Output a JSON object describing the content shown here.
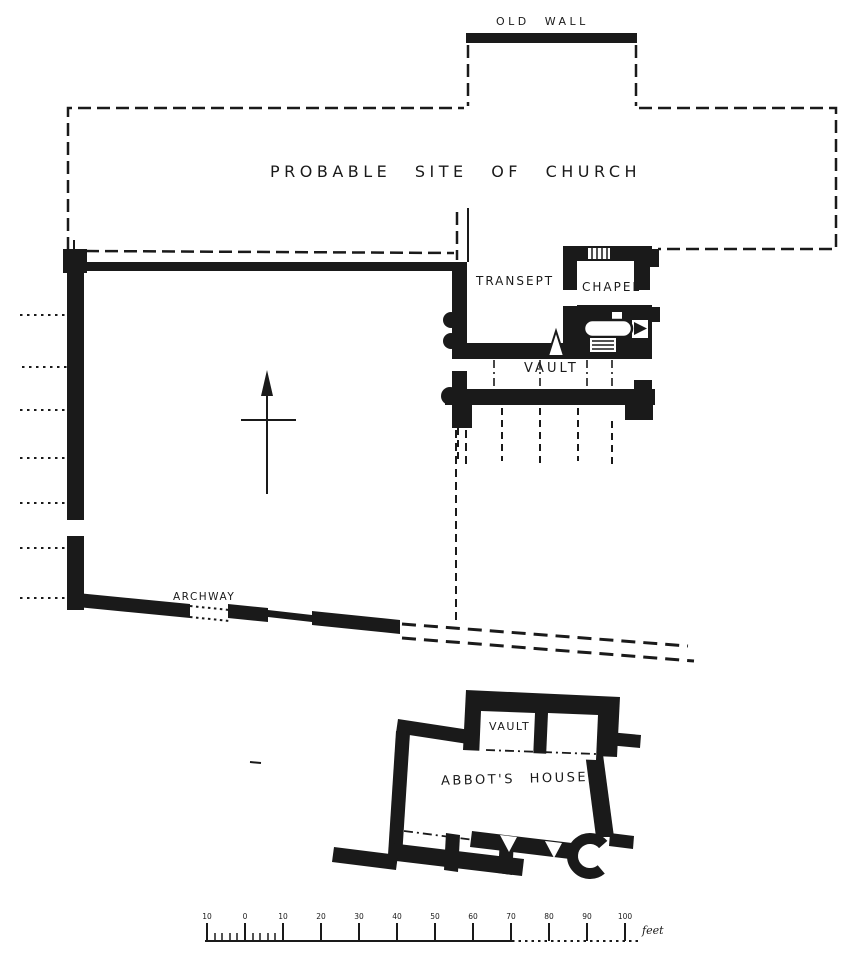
{
  "plan": {
    "labels": {
      "old_wall": "OLD WALL",
      "church_site": "PROBABLE SITE OF CHURCH",
      "transept": "TRANSEPT",
      "chapel": "CHAPEL",
      "vault": "VAULT",
      "archway": "ARCHWAY",
      "abbots_house": "ABBOT'S HOUSE",
      "abbots_house_vault": "VAULT"
    },
    "scale_bar": {
      "tick_labels": [
        "10",
        "0",
        "10",
        "20",
        "30",
        "40",
        "50",
        "60",
        "70",
        "80",
        "90",
        "100"
      ],
      "unit_label": "feet"
    },
    "colors": {
      "ink": "#1a1a1a",
      "paper": "#ffffff"
    }
  }
}
